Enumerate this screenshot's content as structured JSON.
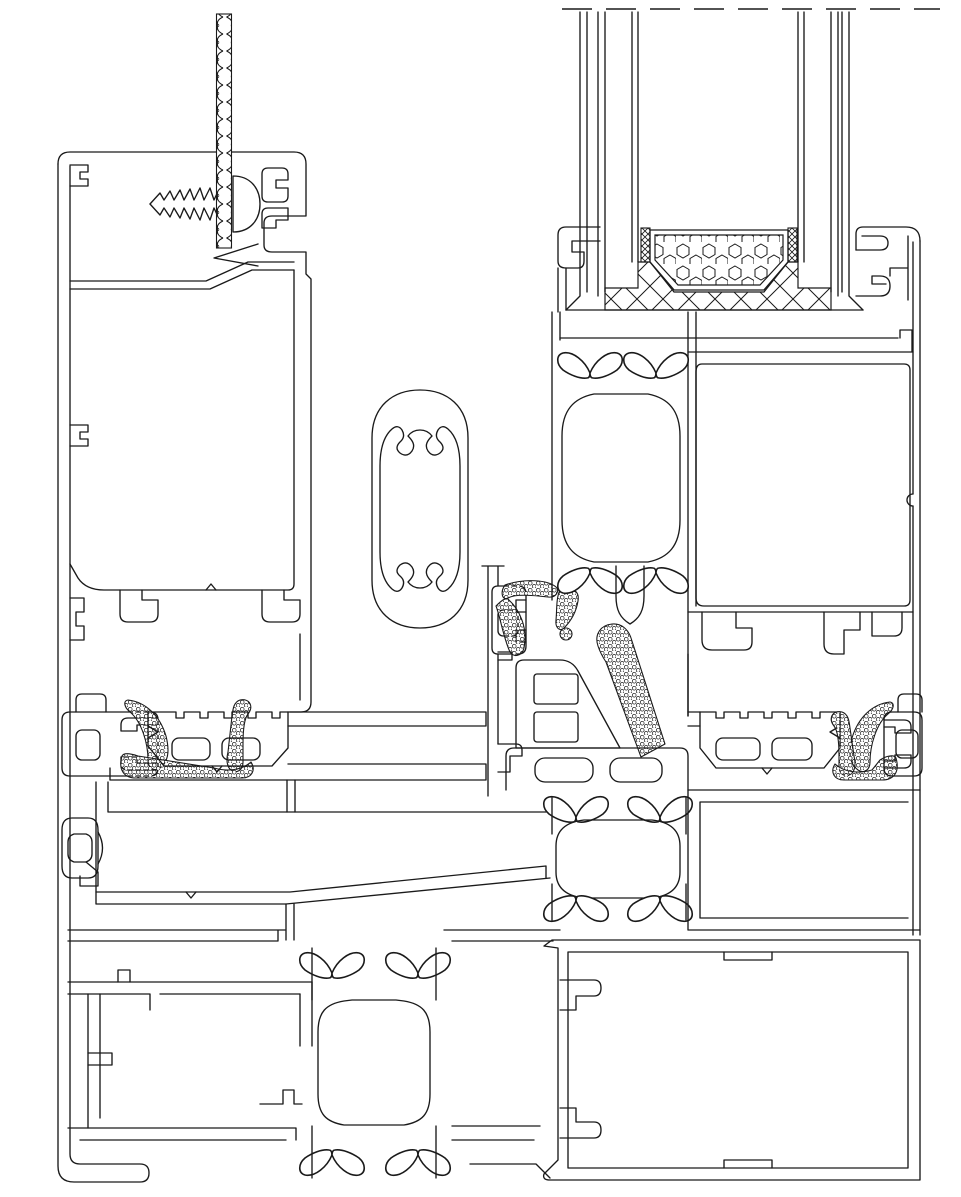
{
  "meta": {
    "title": "Aluminium door threshold and glazing profile cross-section (CAD line drawing)",
    "drawing_type": "technical-section-detail"
  },
  "canvas": {
    "width": 961,
    "height": 1197,
    "background": "#ffffff",
    "ink": "#1a1a1a"
  },
  "patterns": {
    "gasket_fill": "stipple-bubble",
    "desiccant_fill": "hexagon-dots",
    "sealant_fill": "diagonal-crosshatch",
    "spacer_tape_fill": "fine-crosshatch",
    "cable_fill": "braided-strand",
    "glass_break": "dashed-break-line"
  },
  "components": {
    "rope_cable": "braided fixing cable / twisted cord",
    "left_frame": "left outer frame profile",
    "fixing_screw": "self-tapping fixing screw",
    "screw_head": "pan head of fixing screw",
    "screw_clip": "screw channel clip",
    "slot_rails": "bottom T-slot rails of left profile",
    "gasket_profile_left": "left gasket carrier profile",
    "gasket_left": "left EPDM lip gasket (stippled)",
    "tread_insert_left": "left ribbed tread insert with drainage slots",
    "base_plate": "threshold base plate",
    "mid_band": "sloped mid drainage band",
    "snap_clip": "snap-in clip connector",
    "oval_tube": "oval tube profile with screw ports",
    "center_mullion": "central mullion strip",
    "clip_channel_small": "small clip channel",
    "gasket_upper": "upper centre gasket (stippled)",
    "gasket_diagonal": "diagonal centre gasket (stippled)",
    "mullion_block": "mullion chamber block",
    "drainage_bar": "slotted drainage bar",
    "mid_thermal_chamber": "central thermal-break chamber with clips",
    "sash_profile": "sash profile with thermal break",
    "sash_stem": "sash bottom stem",
    "glazing_unit": "insulated glazing unit",
    "glass_pane_left": "outer glass pane",
    "glass_pane_right": "inner glass pane",
    "spacer_bar": "glazing spacer bar",
    "desiccant_fill": "desiccant filling of spacer",
    "edge_tape": "butyl edge tape",
    "sealant_bed": "silicone sealant bed",
    "break_line": "break line (glass continues)",
    "frame_head_right": "right frame head flange",
    "frame_right_wall": "right outer frame wall",
    "frame_chamber_right": "right frame hollow chamber",
    "glazing_bead_slots": "glazing bead T-slots",
    "tread_insert_right": "right ribbed tread insert",
    "gasket_right": "right EPDM lip gasket (stippled)",
    "gasket_profile_right": "right gasket carrier profile",
    "right_lower_box": "right lower hollow box",
    "sill_box": "main sill hollow box",
    "sill_thermal_column": "sill thermal-break column with clips",
    "sill_left_chambers": "left sill stepped chambers",
    "thermal_clip": "polyamide thermal-break clip"
  }
}
